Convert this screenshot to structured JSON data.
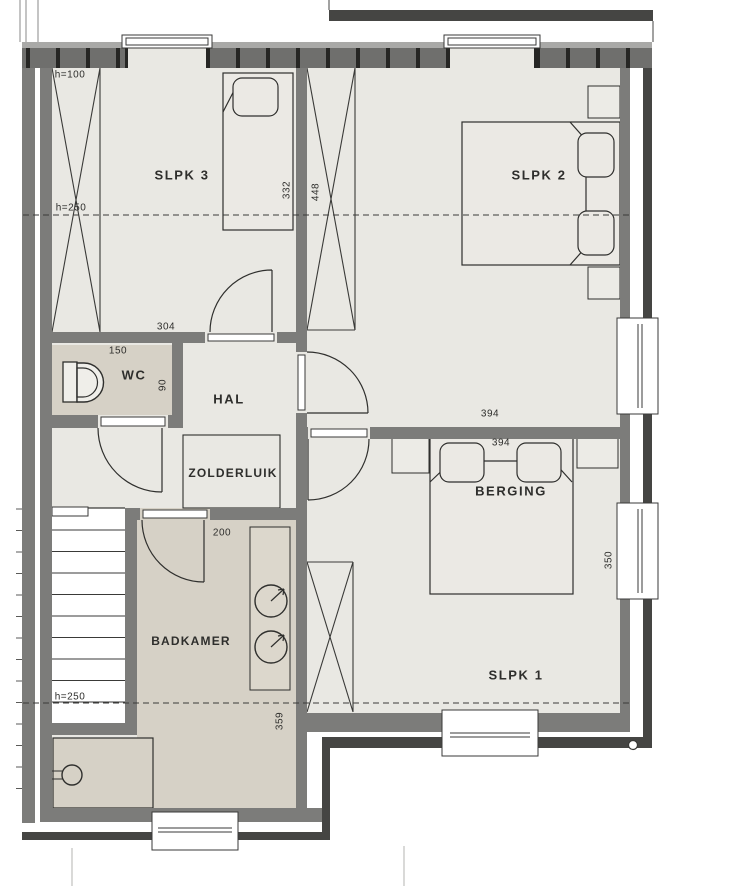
{
  "labels": {
    "rooms": {
      "slpk3": "SLPK 3",
      "slpk2": "SLPK 2",
      "slpk1": "SLPK 1",
      "berging": "BERGING",
      "hal": "HAL",
      "wc": "WC",
      "zolderluik": "ZOLDERLUIK",
      "badkamer": "BADKAMER"
    },
    "dimensions": {
      "slpk3_width": "304",
      "slpk3_depth": "332",
      "slpk2_depth": "448",
      "slpk2_width": "394",
      "slpk1_width": "394",
      "slpk1_depth": "350",
      "wc_width": "150",
      "wc_depth": "90",
      "badkamer_door": "200",
      "badkamer_depth": "359",
      "height_knee": "h=100",
      "height_mid_top": "h=250",
      "height_mid_bottom": "h=250"
    }
  },
  "colors": {
    "wall_gray": "#7c7c7a",
    "wall_dark": "#454543",
    "masonry_block": "#6f6f6d",
    "masonry_joint": "#262624",
    "floor_light": "#e9e8e3",
    "floor_wet": "#d6d1c6",
    "line": "#2f2f2d"
  }
}
